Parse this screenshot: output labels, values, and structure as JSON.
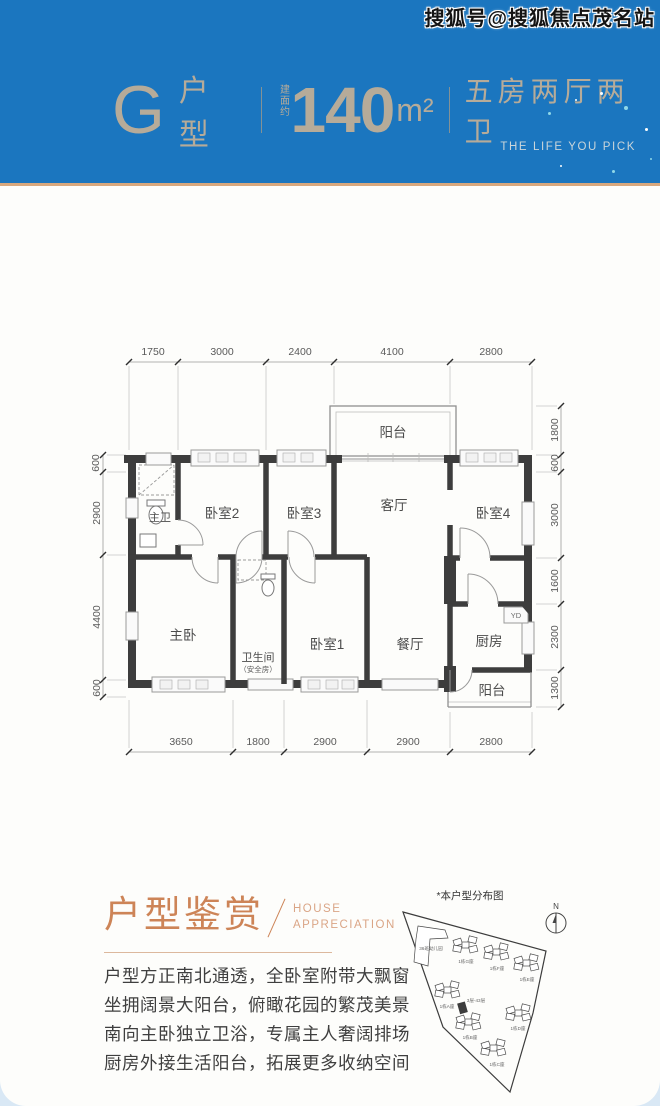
{
  "watermark": "搜狐号@搜狐焦点茂名站",
  "header": {
    "unit_letter": "G",
    "unit_label": "户型",
    "area_prefix": "建面约",
    "area_value": "140",
    "area_unit": "m²",
    "layout_desc": "五房两厅两卫",
    "brand_slogan": "THE LIFE YOU PICK",
    "bg_color": "#1b76bf",
    "title_color": "#b6ab99",
    "accent_line_color": "#d8a87e"
  },
  "floor_plan": {
    "dims_top": [
      "1750",
      "3000",
      "2400",
      "4100",
      "2800"
    ],
    "dims_bottom": [
      "3650",
      "1800",
      "2900",
      "2900",
      "2800"
    ],
    "dims_left": [
      "600",
      "2900",
      "4400",
      "600"
    ],
    "dims_right": [
      "1800",
      "600",
      "3000",
      "1600",
      "2300",
      "1300"
    ],
    "rooms": {
      "balcony_top": "阳台",
      "master_bath": "主卫",
      "bedroom2": "卧室2",
      "bedroom3": "卧室3",
      "living": "客厅",
      "bedroom4": "卧室4",
      "master_bedroom": "主卧",
      "bathroom": "卫生间",
      "bathroom_note": "（安全房）",
      "bedroom1": "卧室1",
      "dining": "餐厅",
      "kitchen": "厨房",
      "balcony_bottom": "阳台",
      "yd_label": "YD"
    }
  },
  "appreciation": {
    "title": "户型鉴赏",
    "subtitle_line1": "HOUSE",
    "subtitle_line2": "APPRECIATION",
    "accent_color": "#cd8457",
    "lines": [
      "户型方正南北通透，全卧室附带大飘窗",
      "坐拥阔景大阳台，俯瞰花园的繁茂美景",
      "南向主卧独立卫浴，专属主人奢阔排场",
      "厨房外接生活阳台，拓展更多收纳空间"
    ]
  },
  "site_map": {
    "title": "*本户型分布图",
    "compass_label": "N",
    "kindergarten": "36班幼儿园",
    "highlight_label": "3层-43层",
    "buildings": [
      "1栋G座",
      "1栋F座",
      "1栋E座",
      "1栋A座",
      "1栋B座",
      "1栋D座",
      "1栋C座"
    ]
  }
}
